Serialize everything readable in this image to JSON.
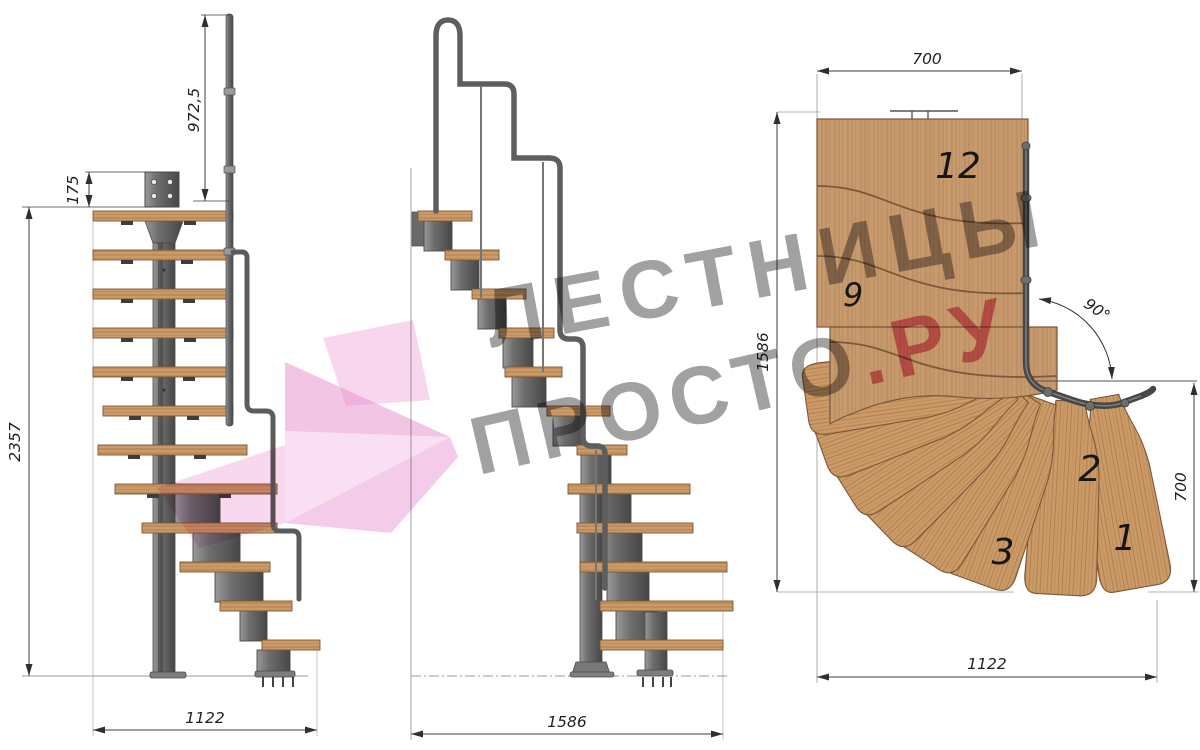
{
  "watermark": {
    "line1": "ЛЕСТНИЦЫ",
    "line2_main": "ПРОСТО",
    "line2_accent": ".РУ",
    "gray": "#7d7d7d",
    "pink": "#d63e6c",
    "arrow_pink": "#e88dcc"
  },
  "front_view": {
    "dims": {
      "handrail_height": "972,5",
      "top_plate": "175",
      "total_height": "2357",
      "base_width": "1122"
    }
  },
  "side_view": {
    "dims": {
      "base_length": "1586"
    }
  },
  "plan_view": {
    "dims": {
      "top_width": "700",
      "left_length": "1586",
      "right_depth": "700",
      "bottom_width": "1122",
      "turn_angle": "90°"
    },
    "steps": {
      "s12": "12",
      "s9": "9",
      "s3": "3",
      "s2": "2",
      "s1": "1"
    }
  },
  "colors": {
    "background": "#ffffff",
    "wood": "#c79a6e",
    "wood_front": "#cb9a66",
    "wood_outline": "#7a5838",
    "metal": "#6f6f6f",
    "metal_dark": "#4a4a4a",
    "dimension": "#333333"
  }
}
